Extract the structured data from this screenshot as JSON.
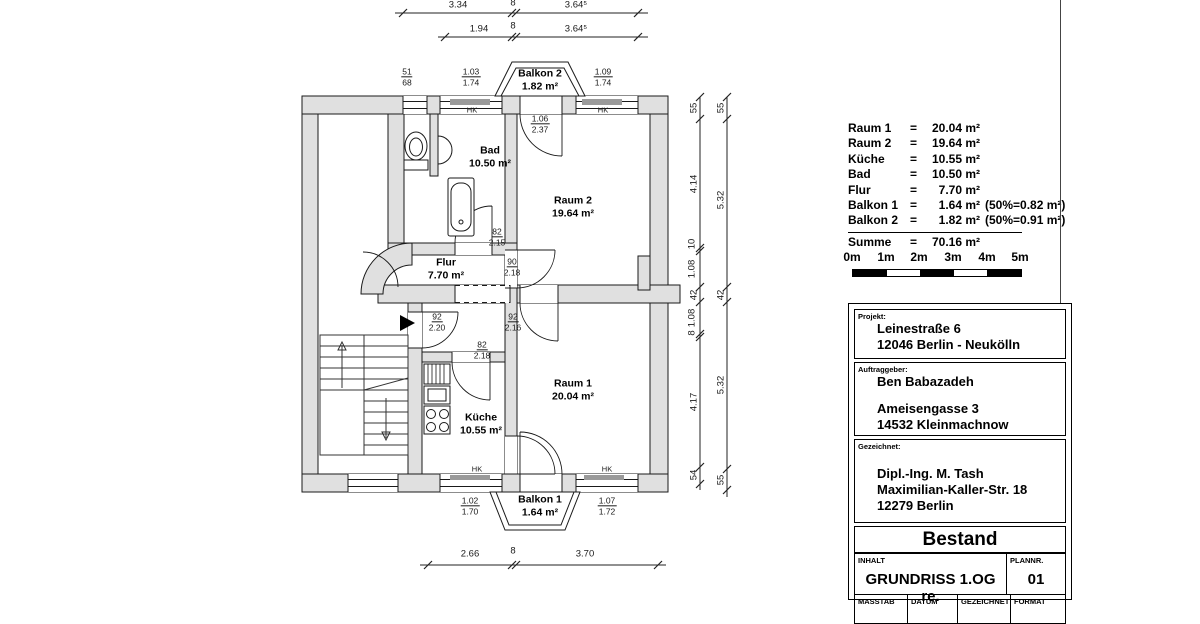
{
  "plan": {
    "rooms": [
      {
        "name": "Balkon 2",
        "area": "1.82 m²"
      },
      {
        "name": "Bad",
        "area": "10.50 m²"
      },
      {
        "name": "Raum 2",
        "area": "19.64 m²"
      },
      {
        "name": "Flur",
        "area": "7.70 m²"
      },
      {
        "name": "Raum 1",
        "area": "20.04 m²"
      },
      {
        "name": "Küche",
        "area": "10.55 m²"
      },
      {
        "name": "Balkon 1",
        "area": "1.64 m²"
      }
    ],
    "openings": [
      {
        "w": "51",
        "h": "68"
      },
      {
        "w": "1.03",
        "h": "1.74"
      },
      {
        "w": "1.09",
        "h": "1.74"
      },
      {
        "w": "1.06",
        "h": "2.37"
      },
      {
        "w": "82",
        "h": "2.15"
      },
      {
        "w": "90",
        "h": "2.18"
      },
      {
        "w": "92",
        "h": "2.20"
      },
      {
        "w": "92",
        "h": "2.16"
      },
      {
        "w": "82",
        "h": "2.18"
      },
      {
        "w": "1.02",
        "h": "1.70"
      },
      {
        "w": "1.07",
        "h": "1.72"
      }
    ],
    "hk": "HK",
    "dims": {
      "top_row1": [
        "3.34",
        "8",
        "3.64⁵"
      ],
      "top_row2": [
        "1.94",
        "8",
        "3.64⁵"
      ],
      "bottom": [
        "2.66",
        "8",
        "3.70"
      ],
      "right_inner": [
        "55",
        "4.14",
        "10",
        "1.08",
        "42",
        "1.08",
        "8",
        "4.17",
        "54"
      ],
      "right_outer": [
        "55",
        "5.32",
        "42",
        "5.32",
        "55"
      ]
    }
  },
  "legend": {
    "eq": "=",
    "rows": [
      {
        "name": "Raum 1",
        "value": "20.04 m²",
        "extra": ""
      },
      {
        "name": "Raum 2",
        "value": "19.64 m²",
        "extra": ""
      },
      {
        "name": "Küche",
        "value": "10.55 m²",
        "extra": ""
      },
      {
        "name": "Bad",
        "value": "10.50 m²",
        "extra": ""
      },
      {
        "name": "Flur",
        "value": "7.70 m²",
        "extra": ""
      },
      {
        "name": "Balkon 1",
        "value": "1.64 m²",
        "extra": "(50%=0.82 m²)"
      },
      {
        "name": "Balkon 2",
        "value": "1.82 m²",
        "extra": "(50%=0.91 m²)"
      }
    ],
    "summe": {
      "name": "Summe",
      "value": "70.16 m²"
    }
  },
  "scalebar": {
    "labels": [
      "0m",
      "1m",
      "2m",
      "3m",
      "4m",
      "5m"
    ],
    "colors": [
      "#000000",
      "#ffffff",
      "#000000",
      "#ffffff",
      "#000000"
    ]
  },
  "titleblock": {
    "projekt_label": "Projekt:",
    "projekt_line1": "Leinestraße 6",
    "projekt_line2": "12046 Berlin - Neukölln",
    "auftraggeber_label": "Auftraggeber:",
    "auftraggeber_line1": "Ben Babazadeh",
    "auftraggeber_line2": "Ameisengasse 3",
    "auftraggeber_line3": "14532 Kleinmachnow",
    "gezeichnet_label": "Gezeichnet:",
    "gezeichnet_line1": "Dipl.-Ing. M. Tash",
    "gezeichnet_line2": "Maximilian-Kaller-Str. 18",
    "gezeichnet_line3": "12279 Berlin",
    "status": "Bestand",
    "inhalt_label": "INHALT",
    "inhalt_value": "GRUNDRISS 1.OG re.",
    "plannr_label": "PLANNR.",
    "plannr_value": "01",
    "footer": [
      "MASSTAB",
      "DATUM",
      "GEZEICHNET",
      "FORMAT"
    ]
  }
}
